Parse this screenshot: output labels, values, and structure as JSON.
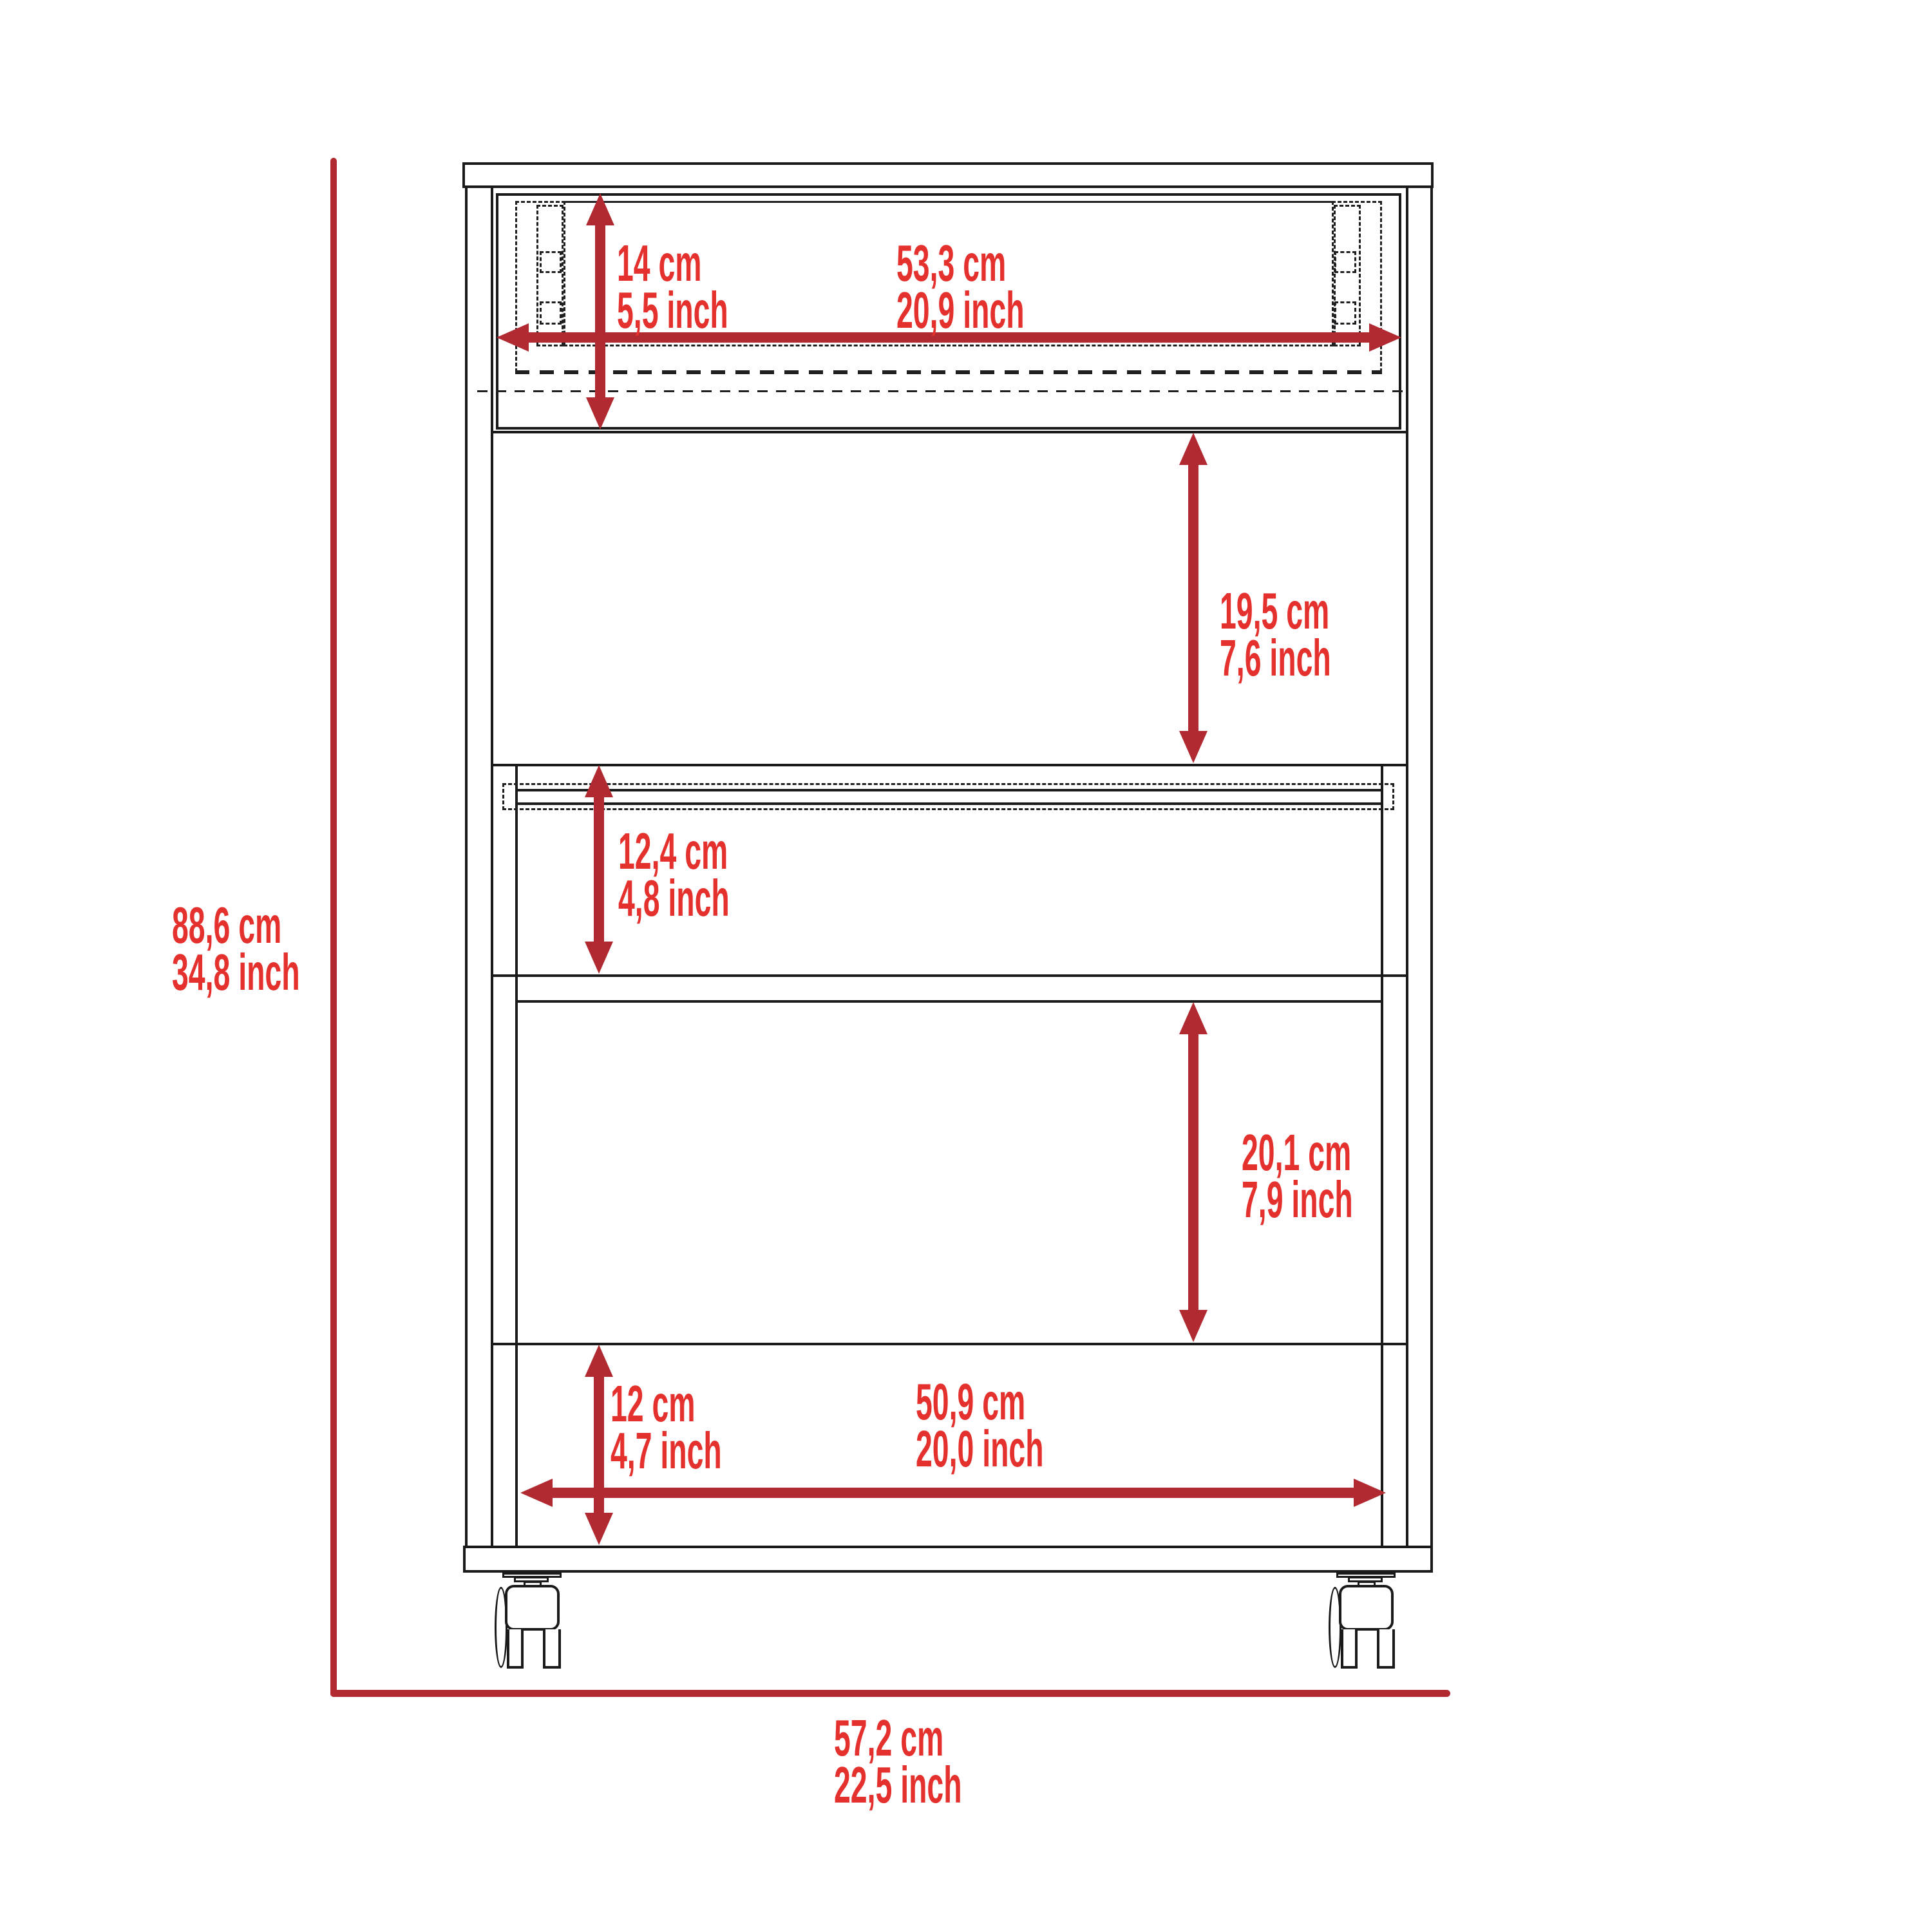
{
  "title": "Rolling cart / cabinet dimension diagram",
  "colors": {
    "dimension_text": "#E5312D",
    "dimension_line": "#B22A31",
    "drawing_outline": "#1a1a1a",
    "background": "#ffffff"
  },
  "dims": {
    "overall_height": {
      "cm": "88,6 cm",
      "inch": "34,8 inch"
    },
    "overall_width": {
      "cm": "57,2 cm",
      "inch": "22,5 inch"
    },
    "drawer_height": {
      "cm": "14 cm",
      "inch": "5,5 inch"
    },
    "drawer_width": {
      "cm": "53,3 cm",
      "inch": "20,9 inch"
    },
    "upper_compartment_height": {
      "cm": "19,5 cm",
      "inch": "7,6 inch"
    },
    "middle_compartment_height": {
      "cm": "12,4 cm",
      "inch": "4,8 inch"
    },
    "lower_compartment_height": {
      "cm": "20,1 cm",
      "inch": "7,9 inch"
    },
    "bottom_shelf_height": {
      "cm": "12 cm",
      "inch": "4,7 inch"
    },
    "bottom_shelf_width": {
      "cm": "50,9 cm",
      "inch": "20,0 inch"
    }
  }
}
